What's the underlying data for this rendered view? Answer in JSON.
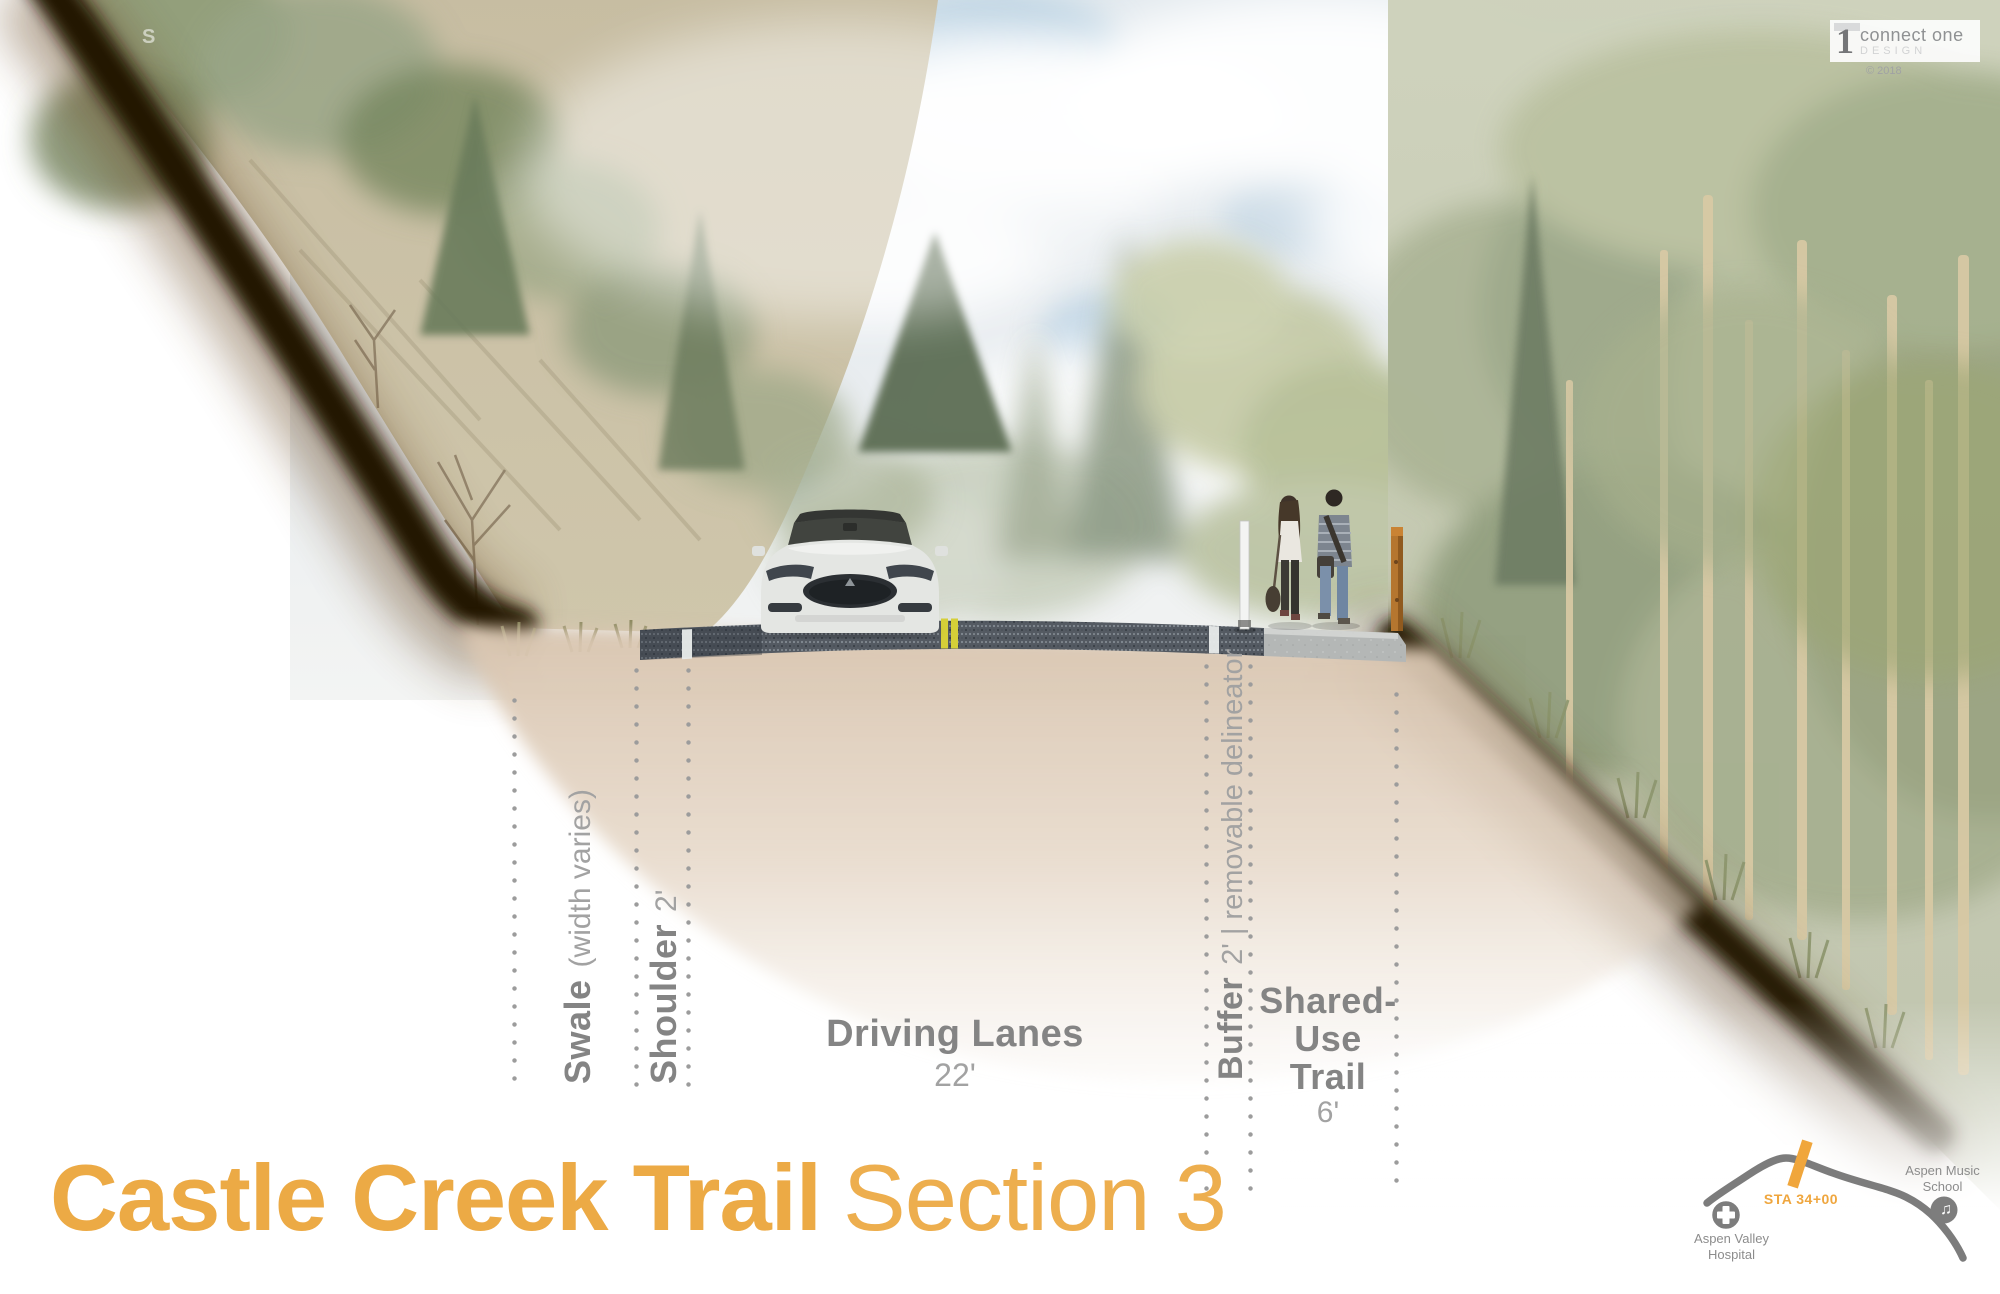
{
  "watermark": "S",
  "logo": {
    "digit": "1",
    "brand": "connect one",
    "subtitle": "DESIGN",
    "copyright": "© 2018"
  },
  "annotations": {
    "swale": {
      "name": "Swale",
      "detail": "(width varies)"
    },
    "shoulder": {
      "name": "Shoulder",
      "detail": "2'"
    },
    "driving_lanes": {
      "name": "Driving Lanes",
      "detail": "22'"
    },
    "buffer": {
      "name": "Buffer",
      "detail": "2'  |  removable delineator"
    },
    "shared_use_trail": {
      "line1": "Shared-",
      "line2": "Use Trail",
      "detail": "6'"
    }
  },
  "title": {
    "main": "Castle Creek Trail",
    "suffix": "Section 3"
  },
  "minimap": {
    "station": "STA 34+00",
    "music_note_glyph": "♫",
    "hospital_line1": "Aspen Valley",
    "hospital_line2": "Hospital",
    "school_line1": "Aspen Music",
    "school_line2": "School"
  },
  "colors": {
    "accent_orange": "#ECAA45",
    "map_orange": "#F0A63C",
    "label_gray": "#848484",
    "detail_gray": "#A2A2A2",
    "map_gray": "#7C7C7C",
    "lane_yellow": "#D5CF38",
    "asphalt_gray": "#51575F",
    "concrete_gray": "#B6B9B8",
    "earth_tan": "#D9C6B1",
    "cut_brown": "#241402"
  }
}
